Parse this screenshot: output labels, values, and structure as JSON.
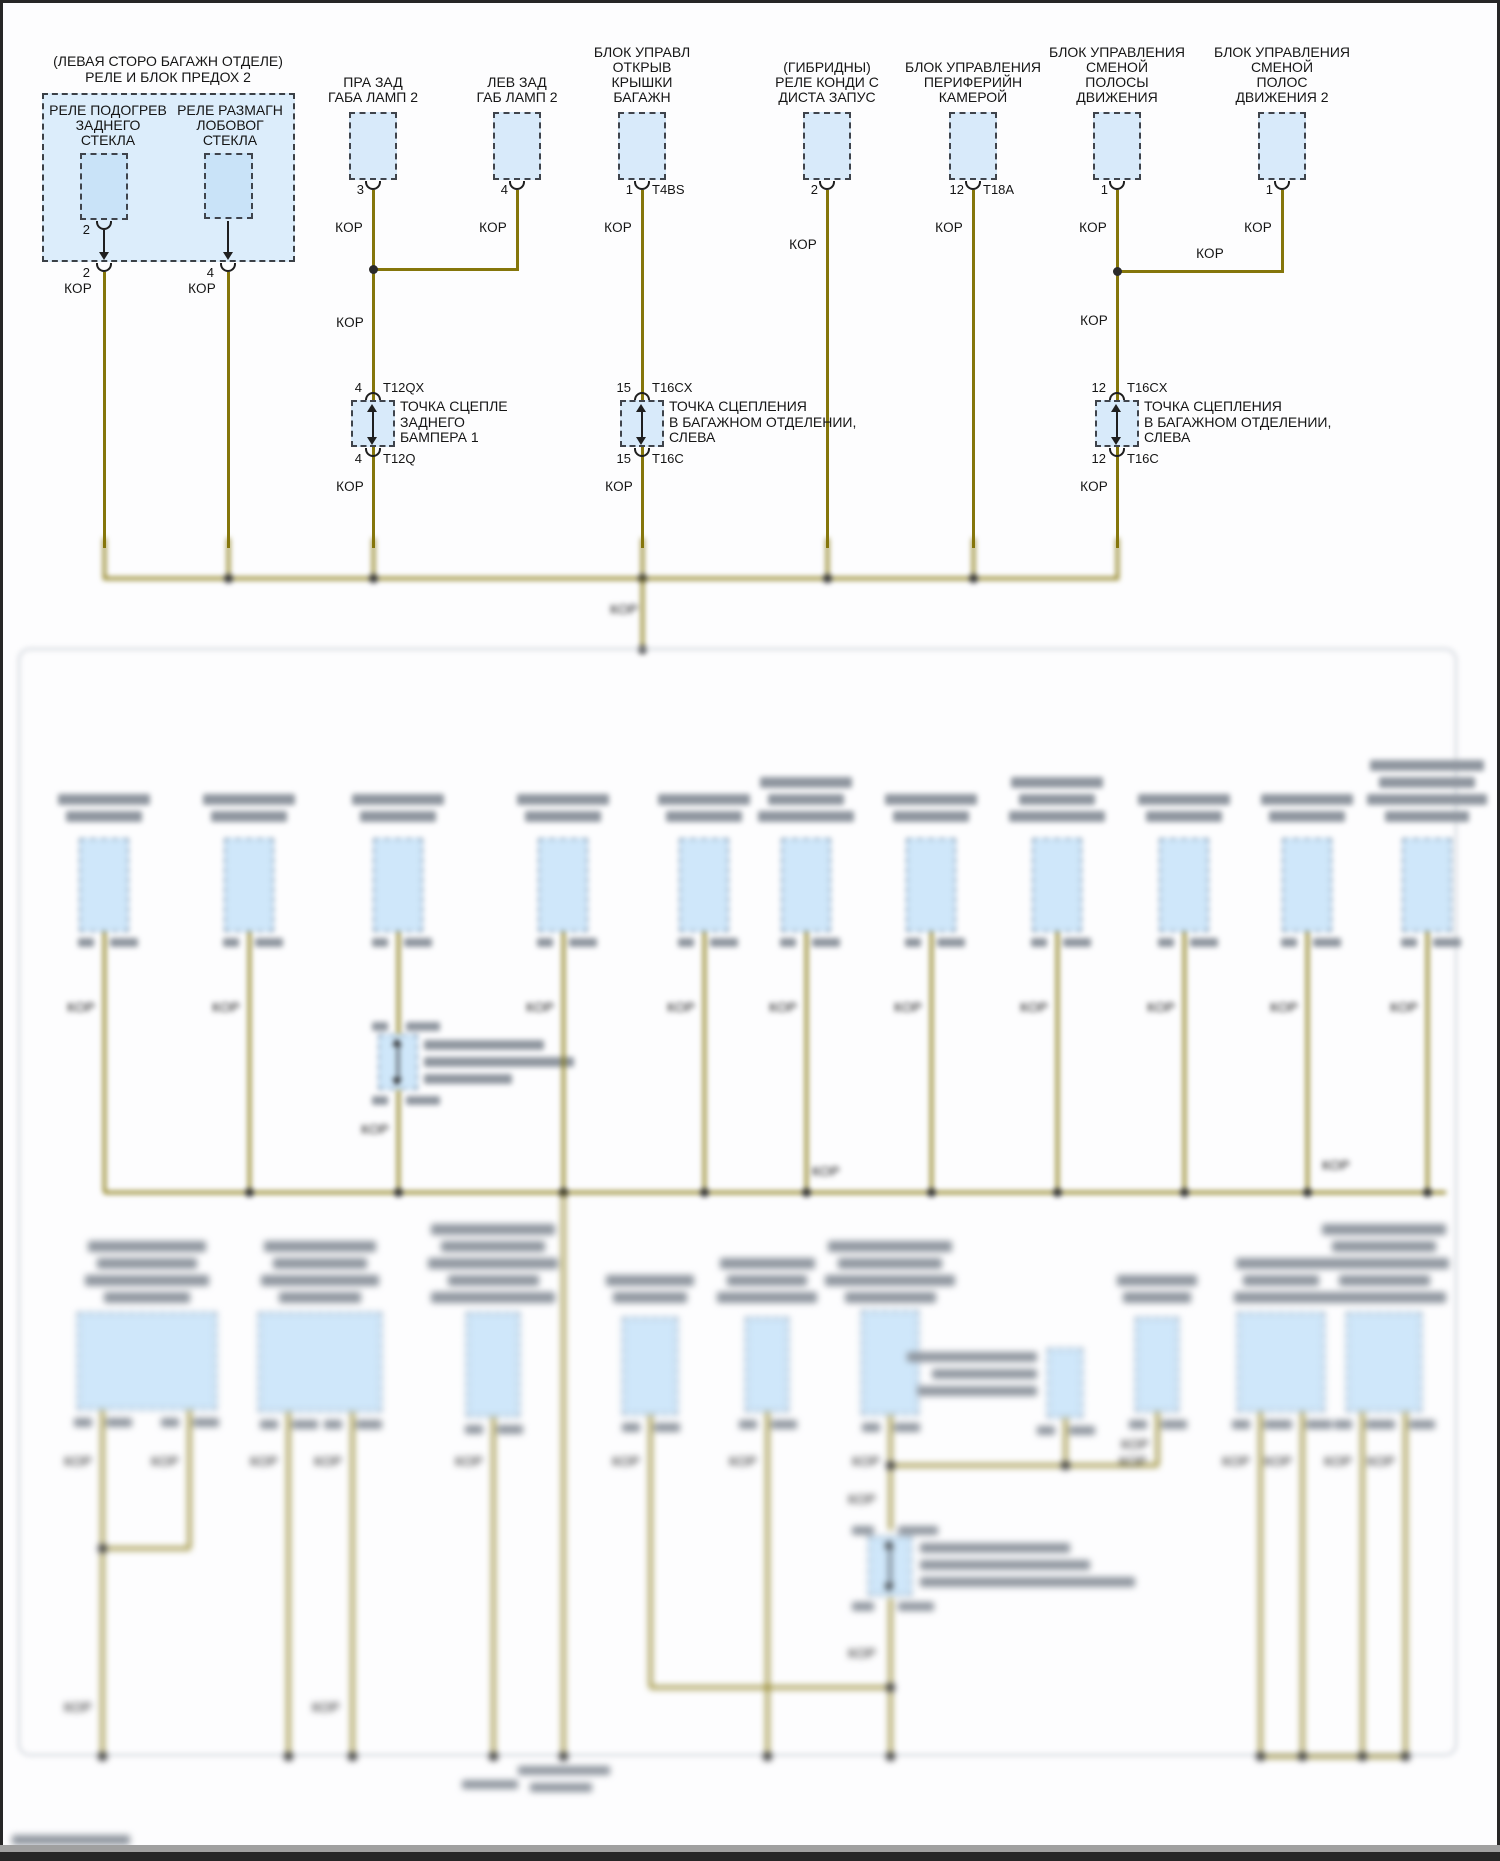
{
  "wire_label": "КОР",
  "title_block": {
    "l1": "(ЛЕВАЯ СТОРО БАГАЖН ОТДЕЛЕ)",
    "l2": "РЕЛЕ И БЛОК ПРЕДОХ 2"
  },
  "relay_box": {
    "relay1": {
      "l1": "РЕЛЕ ПОДОГРЕВ",
      "l2": "ЗАДНЕГО",
      "l3": "СТЕКЛА",
      "inner_pin": "2",
      "exit_pin": "2",
      "wire": "КОР"
    },
    "relay2": {
      "l1": "РЕЛЕ РАЗМАГН",
      "l2": "ЛОБОВОГ",
      "l3": "СТЕКЛА",
      "exit_pin": "4",
      "wire": "КОР"
    }
  },
  "components": [
    {
      "id": "right-rear-marker-lamp-2",
      "cx": 373,
      "lines": [
        "ПРА ЗАД",
        "ГАБА ЛАМП 2"
      ],
      "pin": "3",
      "wire": "КОР"
    },
    {
      "id": "left-rear-marker-lamp-2",
      "cx": 517,
      "lines": [
        "ЛЕВ ЗАД",
        "ГАБ ЛАМП 2"
      ],
      "pin": "4",
      "wire": "КОР"
    },
    {
      "id": "liftgate-control-module",
      "cx": 642,
      "lines": [
        "БЛОК УПРАВЛ",
        "ОТКРЫВ",
        "КРЫШКИ",
        "БАГАЖН"
      ],
      "pin": "1",
      "conn": "T4BS",
      "wire": "КОР"
    },
    {
      "id": "hybrid-remote-start-ac-relay",
      "cx": 827,
      "lines": [
        "(ГИБРИДНЫ)",
        "РЕЛЕ КОНДИ С",
        "ДИСТА ЗАПУС"
      ],
      "pin": "2",
      "wire": "КОР",
      "kor_y": 237
    },
    {
      "id": "surround-camera-module",
      "cx": 973,
      "lines": [
        "БЛОК УПРАВЛЕНИЯ",
        "ПЕРИФЕРИЙН",
        "КАМЕРОЙ"
      ],
      "pin": "12",
      "conn": "T18A",
      "wire": "КОР"
    },
    {
      "id": "lane-change-control-module",
      "cx": 1117,
      "lines": [
        "БЛОК УПРАВЛЕНИЯ",
        "СМЕНОЙ",
        "ПОЛОСЫ",
        "ДВИЖЕНИЯ"
      ],
      "pin": "1",
      "wire": "КОР"
    },
    {
      "id": "lane-change-control-module-2",
      "cx": 1282,
      "lines": [
        "БЛОК УПРАВЛЕНИЯ",
        "СМЕНОЙ",
        "ПОЛОС",
        "ДВИЖЕНИЯ 2"
      ],
      "pin": "1",
      "wire": "КОР"
    }
  ],
  "jumper_wire_label": "КОР",
  "splices": [
    {
      "id": "splice-rear-bumper",
      "cx": 373,
      "pin_top": "4",
      "code_top": "T12QX",
      "pin_bottom": "4",
      "code_bottom": "T12Q",
      "lines": [
        "ТОЧКА СЦЕПЛЕ",
        "ЗАДНЕГО",
        "БАМПЕРА 1"
      ],
      "kor_above_y": 315
    },
    {
      "id": "splice-trunk-left-mid",
      "cx": 642,
      "pin_top": "15",
      "code_top": "T16CX",
      "pin_bottom": "15",
      "code_bottom": "T16C",
      "lines": [
        "ТОЧКА СЦЕПЛЕНИЯ",
        "В БАГАЖНОМ ОТДЕЛЕНИИ,",
        "СЛЕВА"
      ]
    },
    {
      "id": "splice-trunk-left-right",
      "cx": 1117,
      "pin_top": "12",
      "code_top": "T16CX",
      "pin_bottom": "12",
      "code_bottom": "T16C",
      "lines": [
        "ТОЧКА СЦЕПЛЕНИЯ",
        "В БАГАЖНОМ ОТДЕЛЕНИИ,",
        "СЛЕВА"
      ],
      "kor_above_y": 313
    }
  ],
  "drop_wire_label": "КОР",
  "blurred": {
    "note_legible": false,
    "mid_columns_x": [
      104,
      249,
      398,
      563,
      704,
      806,
      931,
      1057,
      1184,
      1307,
      1427
    ],
    "mid_label_rows": [
      2,
      2,
      2,
      2,
      2,
      3,
      2,
      3,
      2,
      2,
      4
    ],
    "mid_splice_column_index": 2,
    "bus_drop_column_index": 3,
    "bottom_components": [
      {
        "x": 77,
        "y": 1312,
        "w": 140,
        "h": 98,
        "rows": 4,
        "pins": [
          102,
          189
        ],
        "base": 124
      },
      {
        "x": 258,
        "y": 1312,
        "w": 124,
        "h": 100,
        "rows": 4,
        "pins": [
          288,
          352
        ],
        "base": 118
      },
      {
        "x": 466,
        "y": 1312,
        "w": 54,
        "h": 105,
        "rows": 5,
        "pins": [
          493
        ],
        "base": 130
      },
      {
        "x": 622,
        "y": 1317,
        "w": 56,
        "h": 98,
        "rows": 2,
        "pins": [
          650
        ],
        "base": 92
      },
      {
        "x": 745,
        "y": 1317,
        "w": 44,
        "h": 95,
        "rows": 3,
        "pins": [
          767
        ],
        "base": 100
      },
      {
        "x": 861,
        "y": 1310,
        "w": 58,
        "h": 105,
        "rows": 4,
        "pins": [
          890
        ],
        "base": 130
      },
      {
        "x": 1047,
        "y": 1348,
        "w": 36,
        "h": 70,
        "rows": 0,
        "pins": [
          1065
        ],
        "base": 0,
        "left_label_rows": 3
      },
      {
        "x": 1135,
        "y": 1317,
        "w": 44,
        "h": 95,
        "rows": 2,
        "pins": [
          1157
        ],
        "base": 85
      },
      {
        "x": 1237,
        "y": 1312,
        "w": 88,
        "h": 100,
        "rows": 3,
        "pins": [
          1260,
          1302
        ],
        "base": 95
      },
      {
        "x": 1346,
        "y": 1312,
        "w": 76,
        "h": 100,
        "rows": 5,
        "pins": [
          1362,
          1405
        ],
        "base": 130
      }
    ]
  },
  "colors": {
    "wire": "#85760b",
    "box_fill": "#d8eafa",
    "relay_fill": "#dcedfb",
    "inner_fill": "#c9e3f8",
    "dash": "#3f444c",
    "blur_bar": "#8f969f",
    "frame": "#262626"
  }
}
